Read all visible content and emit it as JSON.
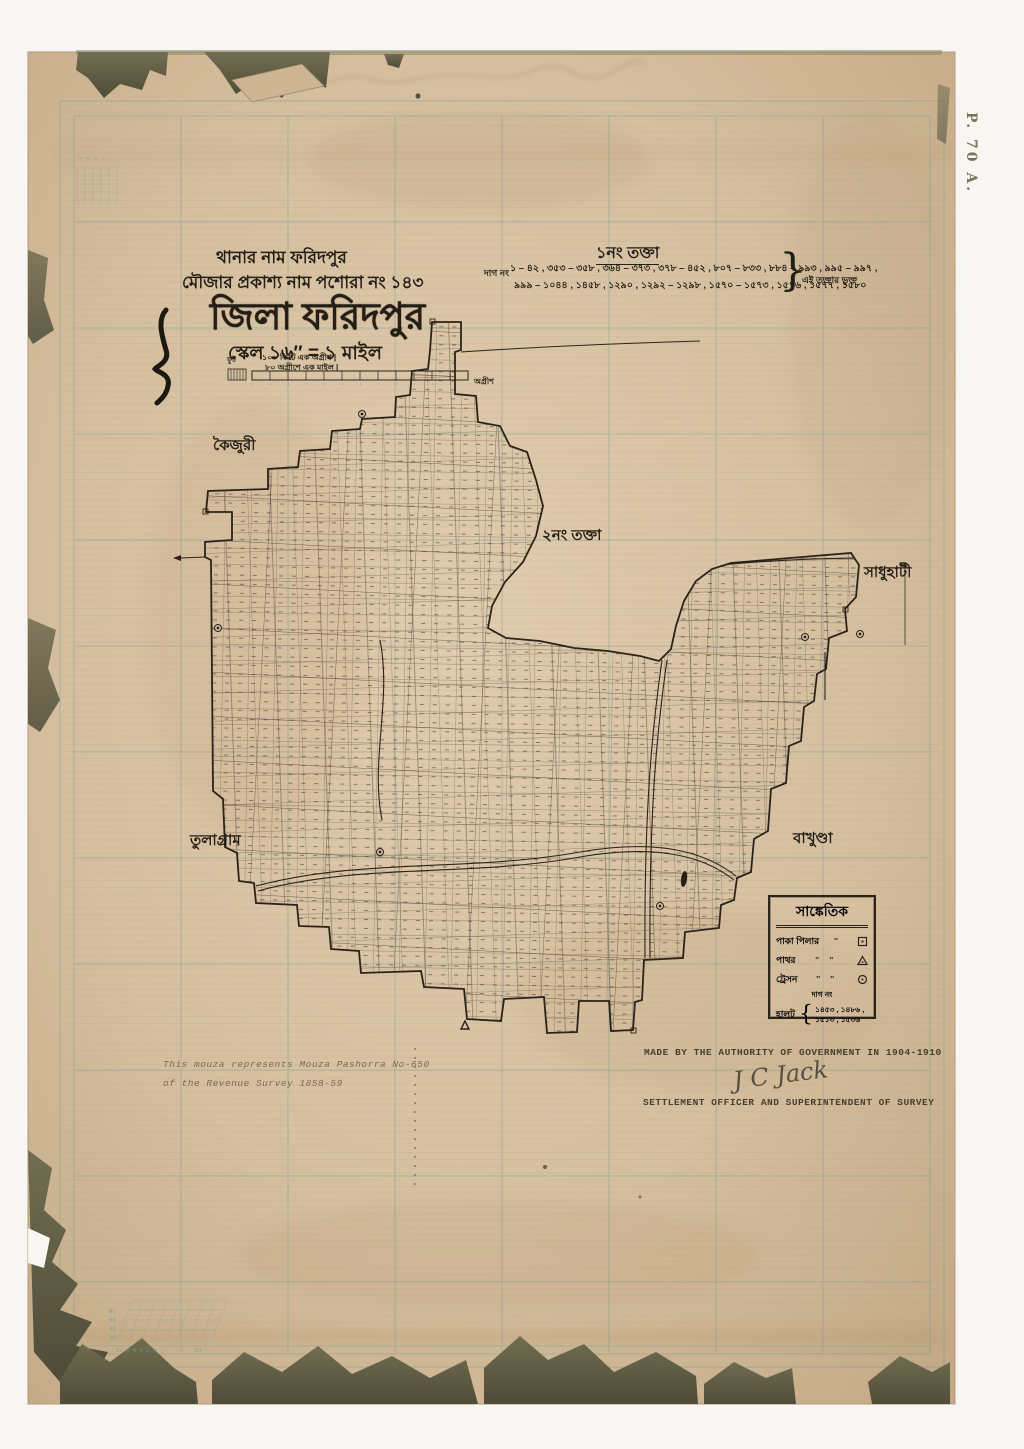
{
  "page": {
    "corner_mark": "P. 70 A."
  },
  "header": {
    "thana_line": "থানার নাম ফরিদপুর",
    "mouza_line": "মৌজার প্রকাশ্য নাম পশোরা নং ১৪৩",
    "district_title": "জিলা ফরিদপুর",
    "scale_line": "স্কেল ১৬″ = ১ মাইল",
    "scalebar": {
      "left_label": "ফুট",
      "line1": "১০০ ফিটে এক অগ্রীশ  |",
      "line2": "৮০ অগ্রীশে এক মাইল  |",
      "right_label": "অগ্রীশ"
    }
  },
  "sheet_note": {
    "title": "১নং তক্তা",
    "prefix": "দাগ নং",
    "line1": "১ – ৪২ , ৩৫৩ – ৩৫৮ , ৩৬৪ – ৩৭৩ , ৩৭৮ – ৪৫২ , ৮০৭ – ৮৩৩ , ৮৮৪ – ৯৯৩ , ৯৯৫ – ৯৯৭ ,",
    "line2": "৯৯৯ – ১০৪৪ , ১৪৫৮ , ১২৯০ , ১২৯২ – ১২৯৮ , ১৫৭০ – ১৫৭৩ , ১৫৭৬ , ১৫৭৭ , ১৫৮০",
    "brace": "}",
    "suffix": "এই তক্তার ভুক্ত"
  },
  "map_labels": {
    "sheet2": "২নং তক্তা",
    "village_nw": "কৈজুরী",
    "village_e": "সাধুহাটী",
    "village_sw": "তুলাগ্রাম",
    "village_se": "বাখুণ্ডা"
  },
  "legend": {
    "title": "সাঙ্কেতিক",
    "rows": [
      {
        "label": "পাকা পিলার",
        "dots": "″",
        "symbol": "square-dot"
      },
      {
        "label": "পাথর",
        "dots": "″  ″",
        "symbol": "triangle"
      },
      {
        "label": "ট্রেসন",
        "dots": "″  ″",
        "symbol": "circle-dot"
      }
    ],
    "dag_heading": "দাগ নং",
    "halot_label": "হালট",
    "halot_line1": "১৪৫৩ , ১৪৮৬ ,",
    "halot_line2": "১৫১৩ , ১৫৩৬"
  },
  "footnotes": {
    "left_line1": "This mouza represents Mouza  Pashorra No-650",
    "left_line2": "of the Revenue Survey 1858-59",
    "right_line1": "MADE BY THE  AUTHORITY OF  GOVERNMENT IN 1904-1910",
    "signature": "J C Jack",
    "right_line2": "SETTLEMENT OFFICER AND SUPERINTENDENT OF SURVEY"
  },
  "grid_calibration": {
    "y_ticks": [
      "80",
      "60",
      "40",
      "20"
    ],
    "x_ticks": [
      "10",
      "8",
      "6",
      "4",
      "2",
      "0",
      "10"
    ]
  },
  "colors": {
    "paper": "#d8c1a3",
    "grid_teal": "#6f9e8e",
    "ink": "#2b231a",
    "torn_backing": "#63604a",
    "typed_faded": "#7d6a52"
  }
}
